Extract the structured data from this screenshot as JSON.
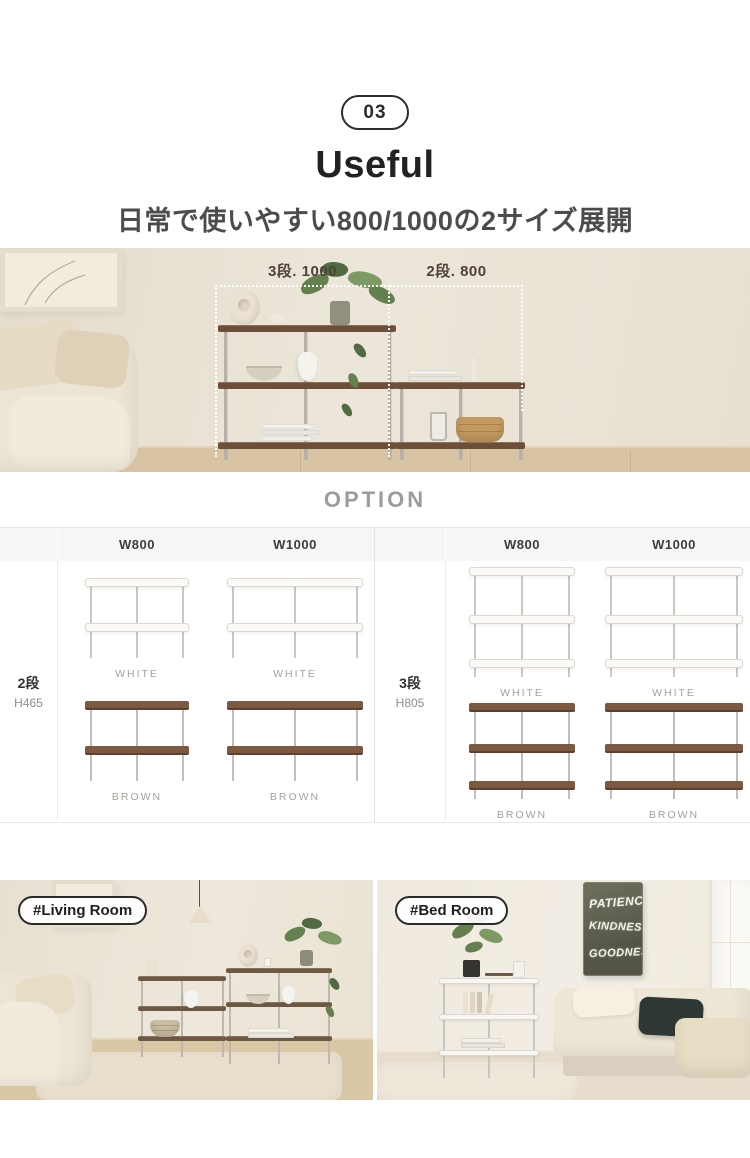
{
  "header": {
    "badge": "03",
    "title": "Useful",
    "subtitle": "日常で使いやすい800/1000の2サイズ展開"
  },
  "hero": {
    "label_left": "3段. 1000",
    "label_right": "2段. 800"
  },
  "option": {
    "heading": "OPTION",
    "tables": [
      {
        "label": "2段",
        "height": "H465",
        "columns": [
          "W800",
          "W1000"
        ],
        "rows": [
          {
            "captions": [
              "WHITE",
              "WHITE"
            ]
          },
          {
            "captions": [
              "BROWN",
              "BROWN"
            ]
          }
        ]
      },
      {
        "label": "3段",
        "height": "H805",
        "columns": [
          "W800",
          "W1000"
        ],
        "rows": [
          {
            "captions": [
              "WHITE",
              "WHITE"
            ]
          },
          {
            "captions": [
              "BROWN",
              "BROWN"
            ]
          }
        ]
      }
    ]
  },
  "rooms": {
    "living_label": "#Living Room",
    "bed_label": "#Bed Room",
    "poster": {
      "line1": "PATIENCE",
      "line2": "KINDNESS",
      "line3": "GOODNESS"
    }
  },
  "colors": {
    "shelf_brown": "#7d5941",
    "leg_silver": "#c2beb6",
    "header_bg": "#f6f6f6",
    "caption_gray": "#a5a29c"
  }
}
